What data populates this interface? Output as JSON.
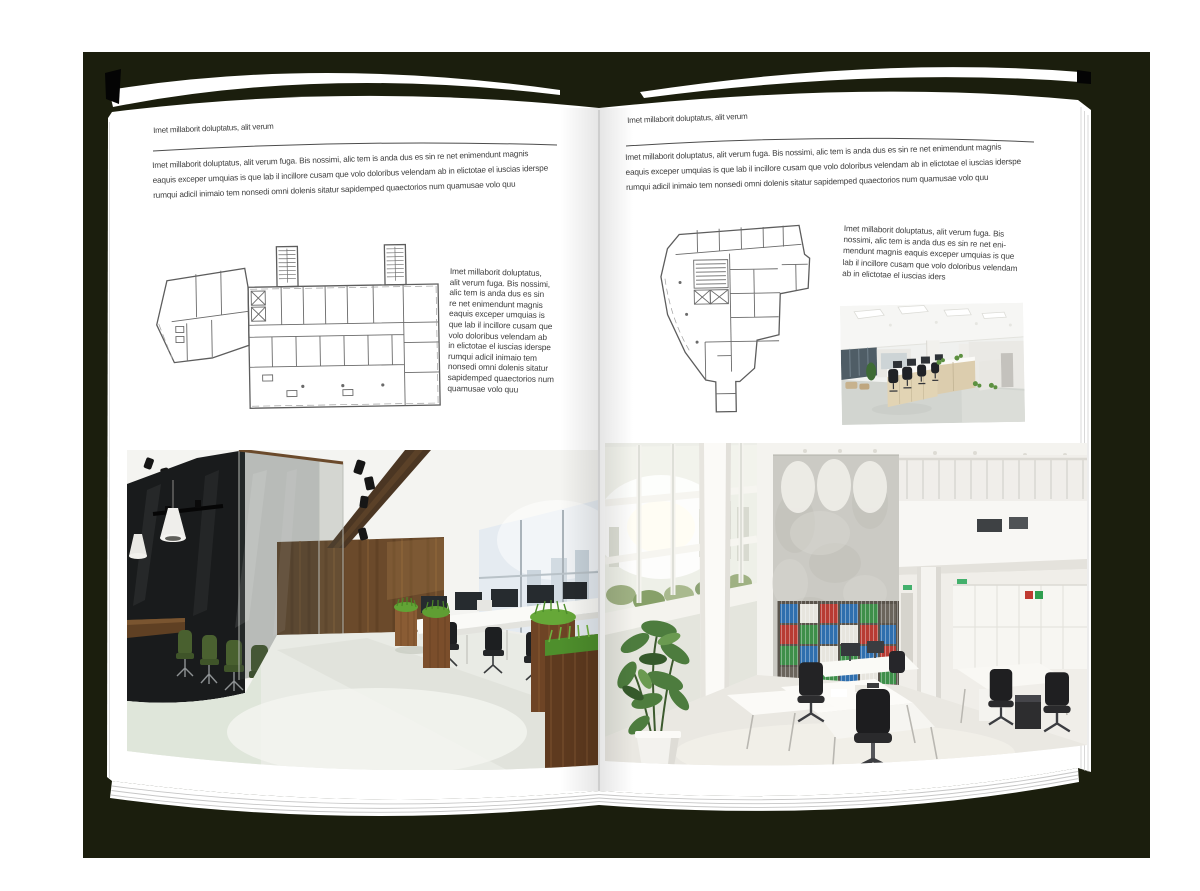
{
  "colors": {
    "backdrop": "#1b1e0d",
    "page": "#ffffff",
    "text": "#3e3e3e"
  },
  "left_page": {
    "header": "Imet millaborit doluptatus, alit verum",
    "intro": "Imet millaborit doluptatus, alit verum fuga. Bis nossimi, alic tem is anda dus es sin re net enimendunt magnis\neaquis exceper umquias is que lab il incillore cusam que volo doloribus velendam ab in elictotae el iuscias iderspe\nrumqui adicil inimaio tem nonsedi omni dolenis sitatur sapidemped quaectorios num quamusae volo quu",
    "side_text": "Imet millaborit doluptatus,\nalit verum fuga. Bis nossimi,\nalic tem is anda dus es sin\nre net enimendunt magnis\neaquis exceper umquias is\nque lab il incillore cusam que\nvolo doloribus velendam ab\nin elictotae el iuscias iderspe\nrumqui adicil inimaio tem\nnonsedi omni dolenis sitatur\nsapidemped quaectorios num\nquamusae volo quu",
    "floor_plan_alt": "Rectangular office building floor plan with two stair towers and angled annex",
    "photo_alt": "Open office with dark glass meeting room, wood panel wall, planters and desks"
  },
  "right_page": {
    "header": "Imet millaborit doluptatus, alit verum",
    "intro": "Imet millaborit doluptatus, alit verum fuga. Bis nossimi, alic tem is anda dus es sin re net enimendunt magnis\neaquis exceper umquias is que lab il incillore cusam que volo doloribus velendam ab in elictotae el iuscias iderspe\nrumqui adicil inimaio tem nonsedi omni dolenis sitatur sapidemped quaectorios num quamusae volo quu",
    "side_text": "Imet millaborit doluptatus, alit verum fuga. Bis\nnossimi, alic tem is anda dus es sin re net eni-\nmendunt magnis eaquis exceper umquias is que\nlab il incillore cusam que volo doloribus velendam\nab in elictotae el iuscias iders",
    "floor_plan_alt": "Irregular wedge-shaped office building floor plan",
    "photo_small_alt": "Open plan office with rows of desks and black chairs",
    "photo_alt": "Double-height white office with window facade, concrete wall and binder shelves"
  }
}
